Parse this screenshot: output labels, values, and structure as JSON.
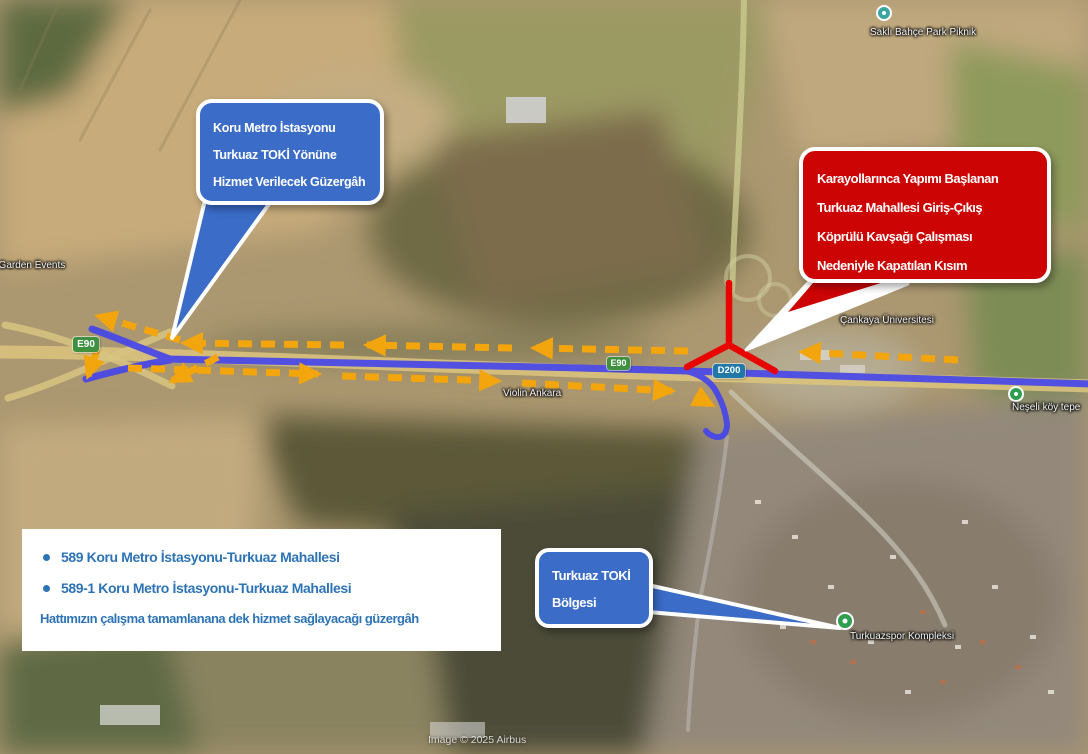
{
  "callouts": {
    "koru": {
      "line1": "Koru Metro İstasyonu",
      "line2": "Turkuaz TOKİ Yönüne",
      "line3": "Hizmet Verilecek Güzergâh"
    },
    "closure": {
      "line1": "Karayollarınca Yapımı Başlanan",
      "line2": "Turkuaz Mahallesi Giriş-Çıkış",
      "line3": "Köprülü Kavşağı Çalışması",
      "line4": "Nedeniyle Kapatılan Kısım"
    },
    "toki": {
      "line1": "Turkuaz TOKİ",
      "line2": "Bölgesi"
    }
  },
  "legend": {
    "bullet1": "589 Koru Metro İstasyonu-Turkuaz Mahallesi",
    "bullet2": "589-1 Koru Metro İstasyonu-Turkuaz Mahallesi",
    "note": "Hattımızın çalışma tamamlanana dek hizmet sağlayacağı güzergâh"
  },
  "map": {
    "attribution": "Image © 2025 Airbus",
    "labels": {
      "garden_events": "di Garden Events",
      "sakli_bahce": "Saklı Bahçe Park Piknik",
      "cankaya": "Çankaya Üniversitesi",
      "violin": "Violin Ankara",
      "neselikoy": "Neşeli köy tepe",
      "turkuazspor": "Turkuazspor Kompleksi"
    },
    "shields": {
      "e90_west": "E90",
      "e90_mid": "E90",
      "d200": "D200"
    }
  },
  "colors": {
    "callout_blue": "#3a6cc8",
    "callout_red": "#cc0404",
    "legend_text": "#2e74b5",
    "route_blue": "#4444ec",
    "detour_arrow_yellow": "#f2a50c",
    "closure_red": "#e90404"
  }
}
